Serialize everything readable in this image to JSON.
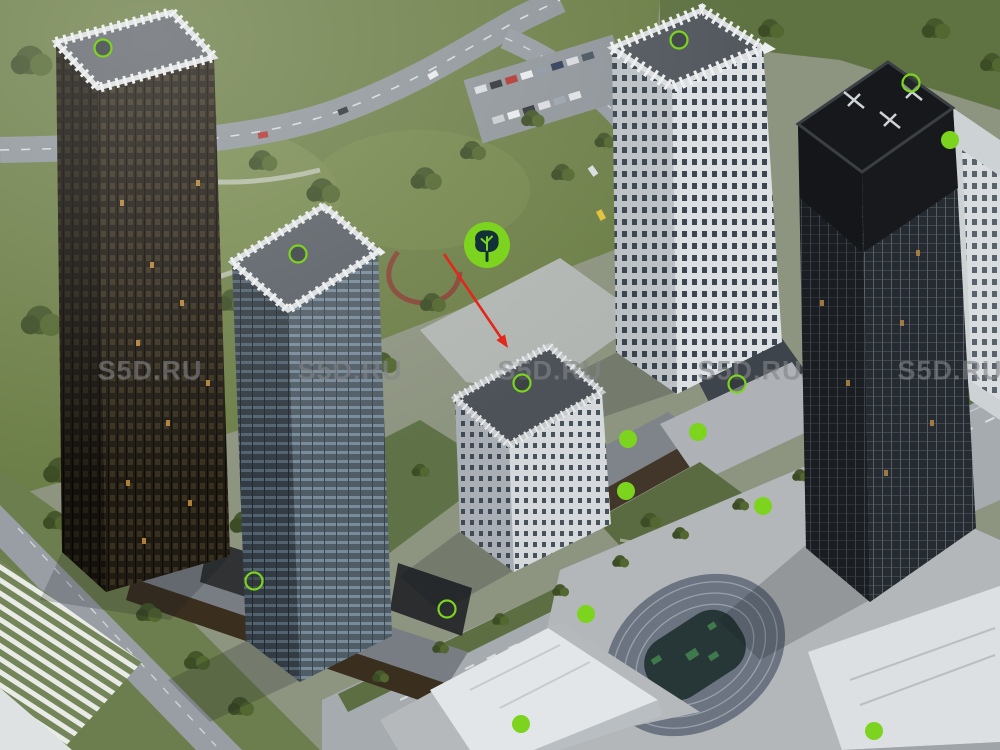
{
  "image": {
    "kind": "aerial-architectural-render",
    "subject": "residential towers complex with park, avenue, school and stadium"
  },
  "watermark": {
    "text": "S5D.RU",
    "row_y": 371,
    "x_positions": [
      150,
      350,
      550,
      750,
      950
    ],
    "color": "rgba(130,133,136,0.62)"
  },
  "annotations": {
    "accent_color": "#7cd41e",
    "ring_fill": "rgba(45,50,52,0.45)",
    "ring_radius": 8.5,
    "ring_stroke_width": 2.2,
    "dot_radius": 9,
    "tree_marker": {
      "cx": 487,
      "cy": 245,
      "r": 23,
      "icon": "tree-icon",
      "icon_color": "#123038"
    },
    "arrow": {
      "x1": 444,
      "y1": 254,
      "x2": 508,
      "y2": 348,
      "color": "#e3271a",
      "width": 2.6
    },
    "rings": [
      {
        "cx": 103,
        "cy": 48
      },
      {
        "cx": 298,
        "cy": 254
      },
      {
        "cx": 679,
        "cy": 40
      },
      {
        "cx": 911,
        "cy": 83
      },
      {
        "cx": 522,
        "cy": 383
      },
      {
        "cx": 737,
        "cy": 384
      },
      {
        "cx": 254,
        "cy": 581
      },
      {
        "cx": 447,
        "cy": 609
      }
    ],
    "dots": [
      {
        "cx": 628,
        "cy": 439
      },
      {
        "cx": 698,
        "cy": 432
      },
      {
        "cx": 626,
        "cy": 491
      },
      {
        "cx": 763,
        "cy": 506
      },
      {
        "cx": 586,
        "cy": 614
      },
      {
        "cx": 521,
        "cy": 724
      },
      {
        "cx": 874,
        "cy": 731
      },
      {
        "cx": 950,
        "cy": 140
      }
    ]
  }
}
